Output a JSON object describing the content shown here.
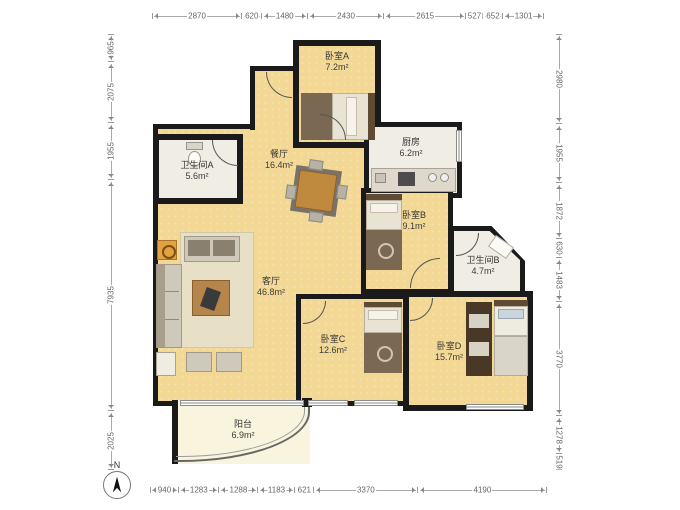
{
  "plan": {
    "rooms": [
      {
        "id": "bedroom-a",
        "name": "卧室A",
        "area": "7.2m²"
      },
      {
        "id": "kitchen",
        "name": "厨房",
        "area": "6.2m²"
      },
      {
        "id": "bathroom-a",
        "name": "卫生间A",
        "area": "5.6m²"
      },
      {
        "id": "dining",
        "name": "餐厅",
        "area": "16.4m²"
      },
      {
        "id": "bedroom-b",
        "name": "卧室B",
        "area": "9.1m²"
      },
      {
        "id": "bathroom-b",
        "name": "卫生间B",
        "area": "4.7m²"
      },
      {
        "id": "living",
        "name": "客厅",
        "area": "46.8m²"
      },
      {
        "id": "bedroom-c",
        "name": "卧室C",
        "area": "12.6m²"
      },
      {
        "id": "bedroom-d",
        "name": "卧室D",
        "area": "15.7m²"
      },
      {
        "id": "balcony",
        "name": "阳台",
        "area": "6.9m²"
      }
    ],
    "dimensions": {
      "top": [
        2870,
        620,
        1480,
        2430,
        2615,
        527,
        652,
        1301
      ],
      "bottom": [
        940,
        1283,
        1288,
        1183,
        621,
        3370,
        4190
      ],
      "left": [
        965,
        2075,
        1955,
        7935,
        2025
      ],
      "right": [
        2980,
        1955,
        1872,
        630,
        1483,
        3770,
        1278,
        519
      ]
    },
    "compass": {
      "label": "N"
    },
    "colors": {
      "wall": "#1a1a1a",
      "room_fill": "#f2d894",
      "wet_room_fill": "#efede4",
      "balcony_fill": "#f8f4dd",
      "furniture_brown": "#b5854c",
      "dimension_line": "#999999",
      "dimension_text": "#666666",
      "label_text": "#333333"
    }
  }
}
